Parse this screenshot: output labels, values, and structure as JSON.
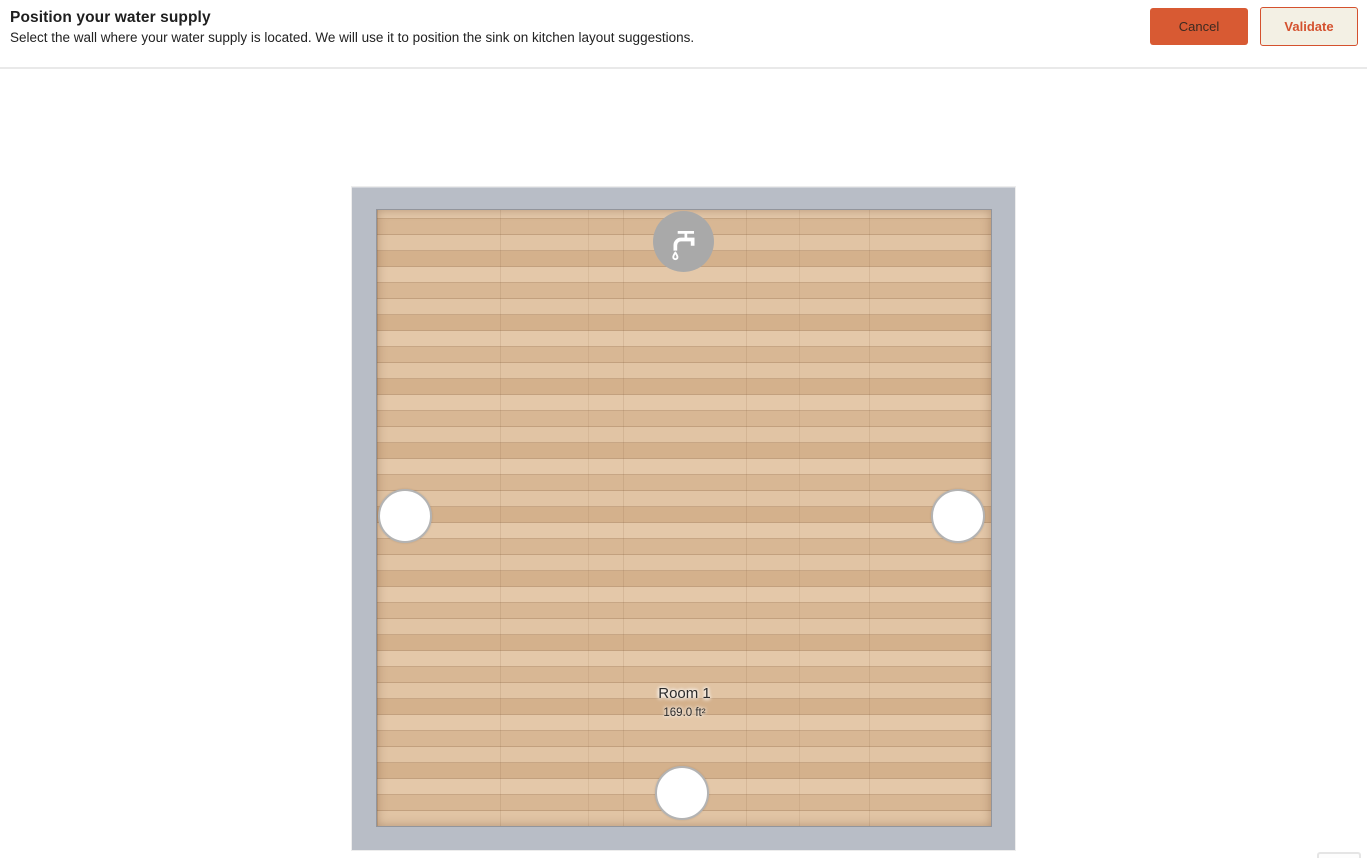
{
  "header": {
    "title": "Position your water supply",
    "subtitle": "Select the wall where your water supply is located. We will use it to position the sink on kitchen layout suggestions.",
    "cancel_label": "Cancel",
    "validate_label": "Validate"
  },
  "room": {
    "name": "Room 1",
    "area": "169.0 ft²",
    "wall_selectors": [
      {
        "wall": "top",
        "selected": true,
        "icon": "faucet-icon"
      },
      {
        "wall": "left",
        "selected": false
      },
      {
        "wall": "right",
        "selected": false
      },
      {
        "wall": "bottom",
        "selected": false
      }
    ]
  },
  "colors": {
    "accent_orange": "#d85a33",
    "validate_text": "#d4512e",
    "validate_bg": "#f3f0e4",
    "wall_gray": "#b8bdc6",
    "floor_wood": "#dcbd9c",
    "selected_dot_gray": "#a9a9a9",
    "header_border": "#e9e9e9"
  }
}
